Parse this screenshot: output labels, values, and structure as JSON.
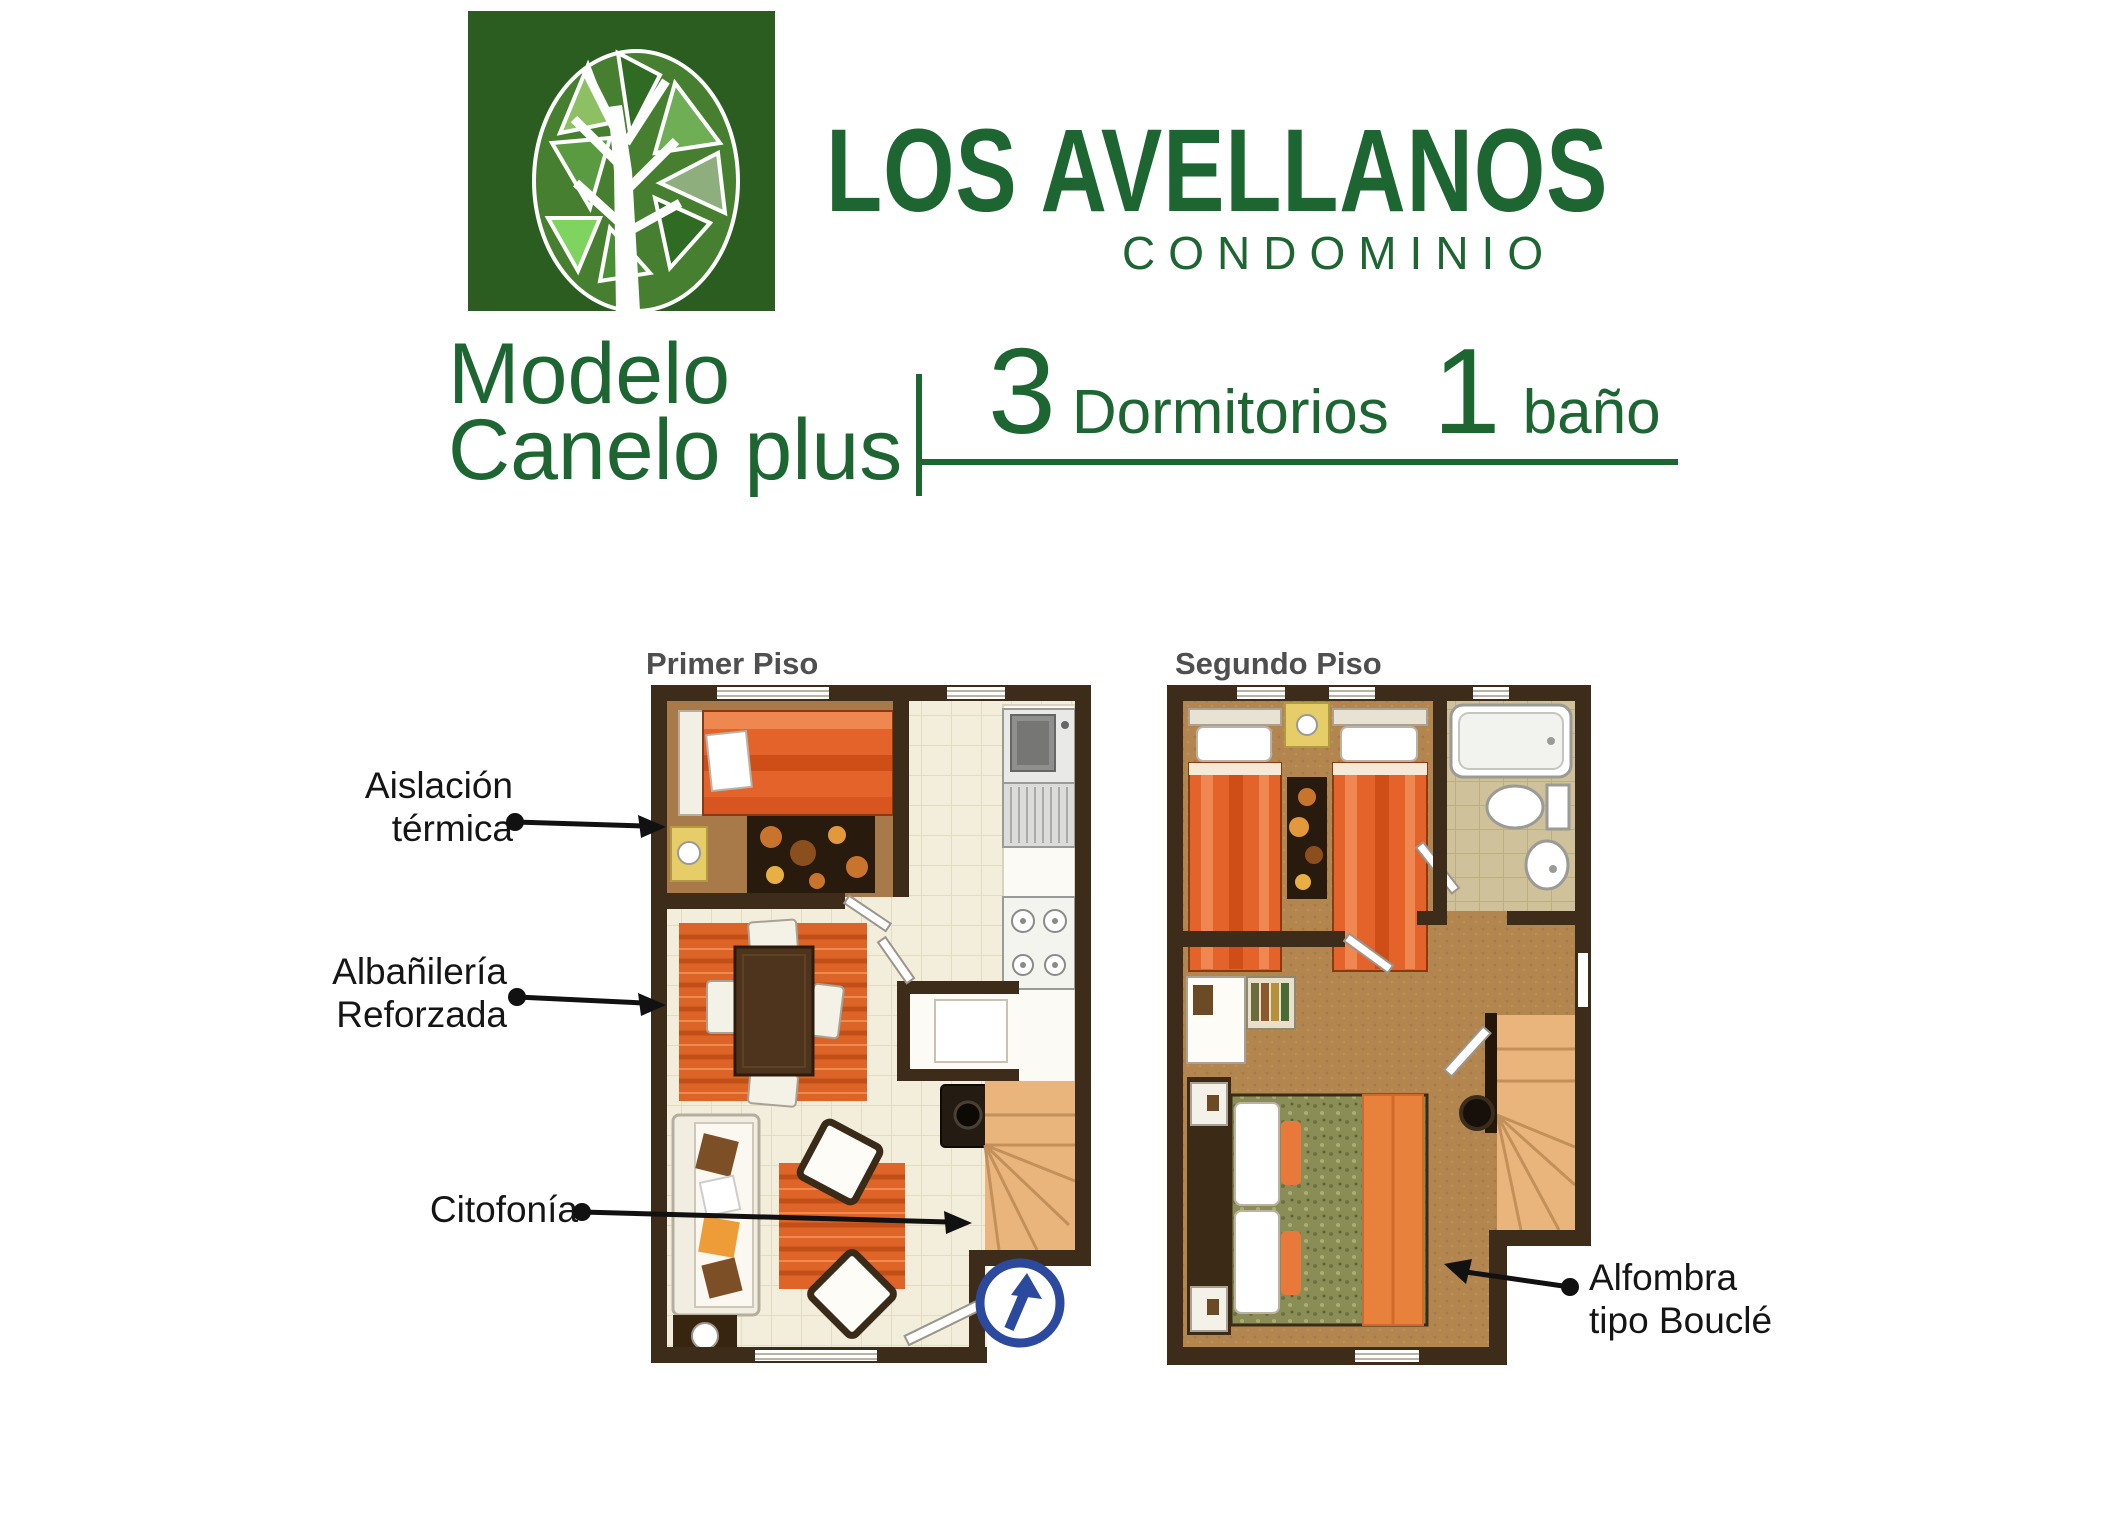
{
  "logo": {
    "icon": "tree-logo",
    "title": "LOS AVELLANOS",
    "subtitle": "CONDOMINIO"
  },
  "model": {
    "line1": "Modelo",
    "line2": "Canelo plus"
  },
  "specs": {
    "bedrooms_count": "3",
    "bedrooms_label": "Dormitorios",
    "bathrooms_count": "1",
    "bathrooms_label": "baño"
  },
  "plans": {
    "first_label": "Primer Piso",
    "second_label": "Segundo Piso"
  },
  "annotations": {
    "aislacion": {
      "line1": "Aislación",
      "line2": "térmica"
    },
    "albanileria": {
      "line1": "Albañilería",
      "line2": "Reforzada"
    },
    "citofonia": {
      "line1": "Citofonía"
    },
    "alfombra": {
      "line1": "Alfombra",
      "line2": "tipo Bouclé"
    }
  },
  "colors": {
    "brand_green": "#2b5d20",
    "text_green": "#1d6632",
    "label_gray": "#4f4f4f",
    "annotation_black": "#151515",
    "wall_brown": "#3e2c1b",
    "arrow_blue": "#2b4a9e",
    "bed_orange": "#e4632a",
    "carpet_tan": "#b3854f",
    "tile_cream": "#f3eedb"
  }
}
